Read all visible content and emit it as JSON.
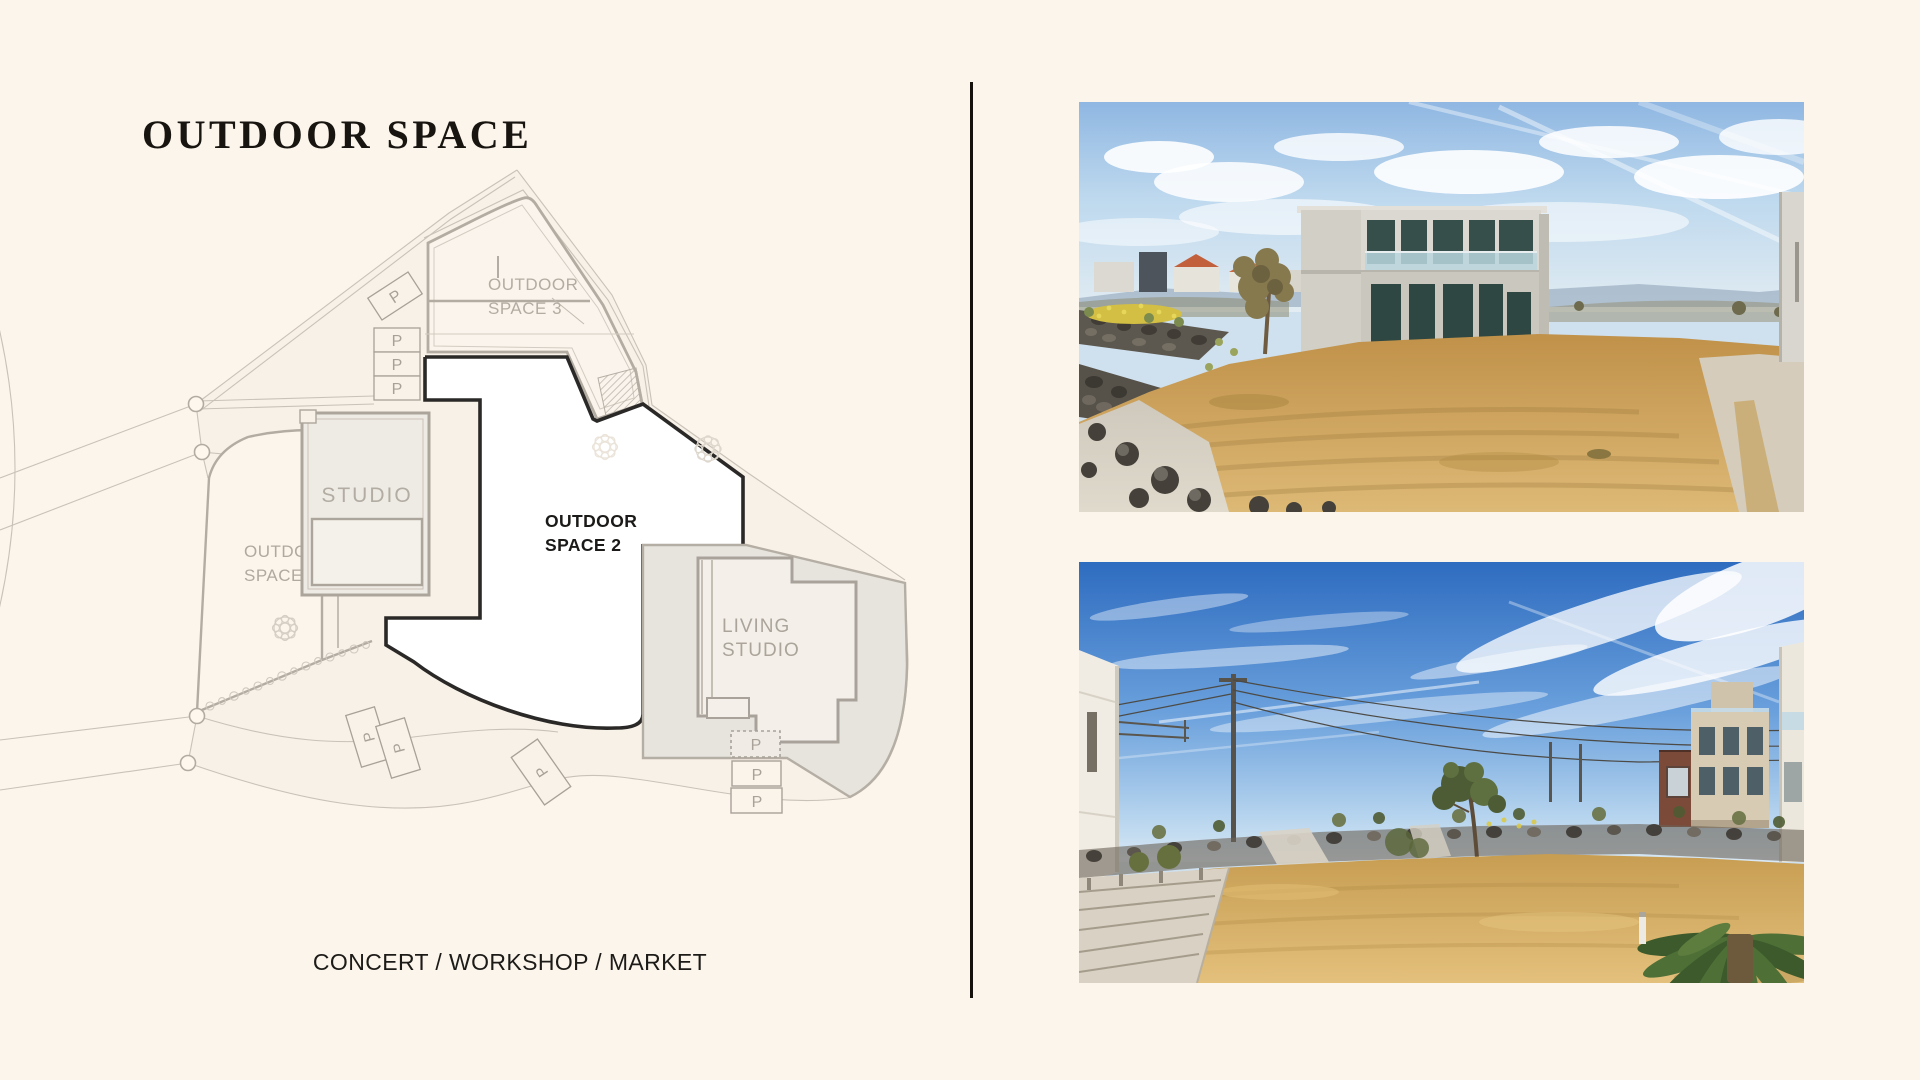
{
  "page": {
    "background": "#FCF5EB",
    "divider_color": "#15120E"
  },
  "header": {
    "title": "OUTDOOR SPACE"
  },
  "plan": {
    "labels": {
      "space1": {
        "line1": "OUTDOOR",
        "line2": "SPACE 1"
      },
      "space2": {
        "line1": "OUTDOOR",
        "line2": "SPACE 2"
      },
      "space3": {
        "line1": "OUTDOOR",
        "line2": "SPACE 3"
      },
      "studio": "STUDIO",
      "living": {
        "line1": "LIVING",
        "line2": "STUDIO"
      },
      "parking": "P"
    },
    "colors": {
      "outline_black": "#2B2927",
      "outline_gray": "#B3ACA2",
      "thin_line": "#C9C2B8",
      "label_gray": "#B0A99F",
      "label_black": "#1B1A18",
      "road_fill": "#F8F1E7",
      "space2_fill": "#FFFFFF",
      "building_fill": "#EEEBE5"
    }
  },
  "caption": {
    "text": "CONCERT / WORKSHOP / MARKET"
  }
}
